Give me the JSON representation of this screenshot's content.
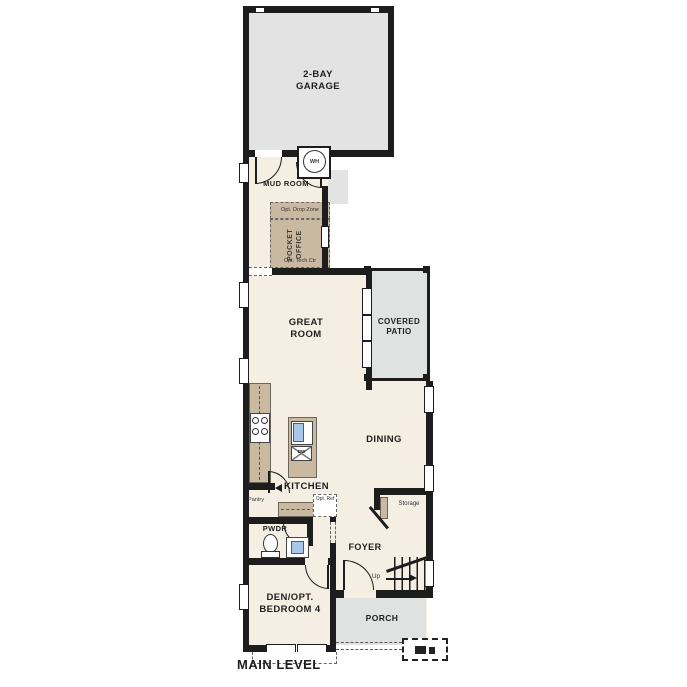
{
  "title": "MAIN LEVEL",
  "rooms": {
    "garage": "2-BAY GARAGE",
    "mud_room": "MUD ROOM",
    "opt_drop_zone": "Opt. Drop Zone",
    "pocket_office": "POCKET OFFICE",
    "opt_tech_ctr": "Opt. Tech Ctr",
    "great_room": "GREAT ROOM",
    "covered_patio": "COVERED PATIO",
    "dining": "DINING",
    "kitchen": "KITCHEN",
    "pantry": "Pantry",
    "opt_ref": "Opt. Ref",
    "storage": "Storage",
    "foyer": "FOYER",
    "up": "Up",
    "pwdr": "PWDR",
    "den": "DEN/OPT. BEDROOM 4",
    "porch": "PORCH",
    "water_heater": "WH",
    "dishwasher": "DW"
  },
  "colors": {
    "wall": "#1d1d1d",
    "interior": "#f5efe3",
    "garage": "#e3e3e3",
    "patio": "#e0e1e1",
    "casework": "#c9b9a1",
    "sink": "#a9c7e6",
    "dash": "#666666"
  }
}
